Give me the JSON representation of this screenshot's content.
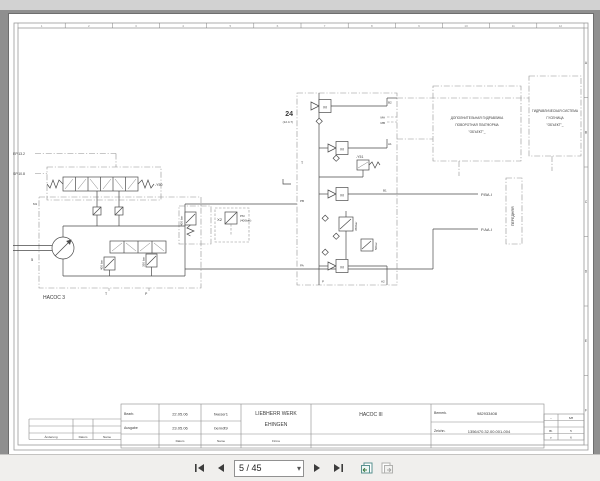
{
  "toolbar": {
    "page_field": "5 / 45"
  },
  "grid": {
    "cols": [
      "1",
      "2",
      "3",
      "4",
      "5",
      "6",
      "7",
      "8",
      "9",
      "10",
      "11",
      "12"
    ],
    "rows": [
      "A",
      "B",
      "C",
      "D",
      "E",
      "F"
    ]
  },
  "left": {
    "ref1": "EP.13.2",
    "ref2": "SP.10.8",
    "valve_id": "-Y50",
    "pump_title": "НАСОС 3",
    "p400a": "400 bar",
    "p350": "350 bar",
    "p400b": "400 bar",
    "tp_id": "X2",
    "tp_note1": "PM",
    "tp_note2": "(400bar)",
    "port_m1": "M1",
    "port_5": "5",
    "port_t": "T",
    "port_p": "P"
  },
  "mid": {
    "block_id": "24",
    "block_ref": "(12.4.7)",
    "valve_id": "-Y51",
    "motor": "M",
    "p350": "350bar",
    "p50": "50bar",
    "ports": {
      "b2": "B2",
      "ma": "MA",
      "mb": "MB",
      "a1": "A1",
      "b1": "B1",
      "pb": "PB",
      "pa": "PA",
      "p": "P",
      "a2": "A2",
      "t": "T"
    }
  },
  "right": {
    "box1": [
      "ДОПОЛНИТЕЛЬНАЯ ГИДРАВЛИКА",
      "ПОВОРОТНАЯ ПЛАТФОРМА",
      "\"ОБЪЕКТ\"_"
    ],
    "box2": [
      "ГИДРАВЛИЧЕСКАЯ СИСТЕМА",
      "ГУСЕНИЦА",
      "\"ОБЪЕКТ\"_"
    ],
    "front": "ПЕРЕДНЯЯ",
    "port1": "P.BA.I",
    "port2": "P.AA.I"
  },
  "titleblock": {
    "rev": {
      "change": "Änderung",
      "date": "Datum",
      "name": "Name"
    },
    "row1": {
      "label": "Bearb.",
      "date": "22.05.06",
      "name": "fweser1"
    },
    "row2": {
      "label": "Ausgabe",
      "date": "23.05.06",
      "name": "berndt9"
    },
    "bottom": {
      "date": "Datum",
      "name": "Name",
      "firm": "Firma"
    },
    "company1": "LIEBHERR WERK",
    "company2": "EHINGEN",
    "doc_title": "НАСОС III",
    "id_label": "Bemerk.",
    "id_value": "982933408",
    "dwg_label": "Zeichn.",
    "dwg_value": "1356470.32.00.001-004",
    "sheet": {
      "r1a": "–",
      "r1b": "6/8",
      "r2a": "Bl.",
      "r2b": "5",
      "r3a": "v.",
      "r3b": "6"
    }
  }
}
